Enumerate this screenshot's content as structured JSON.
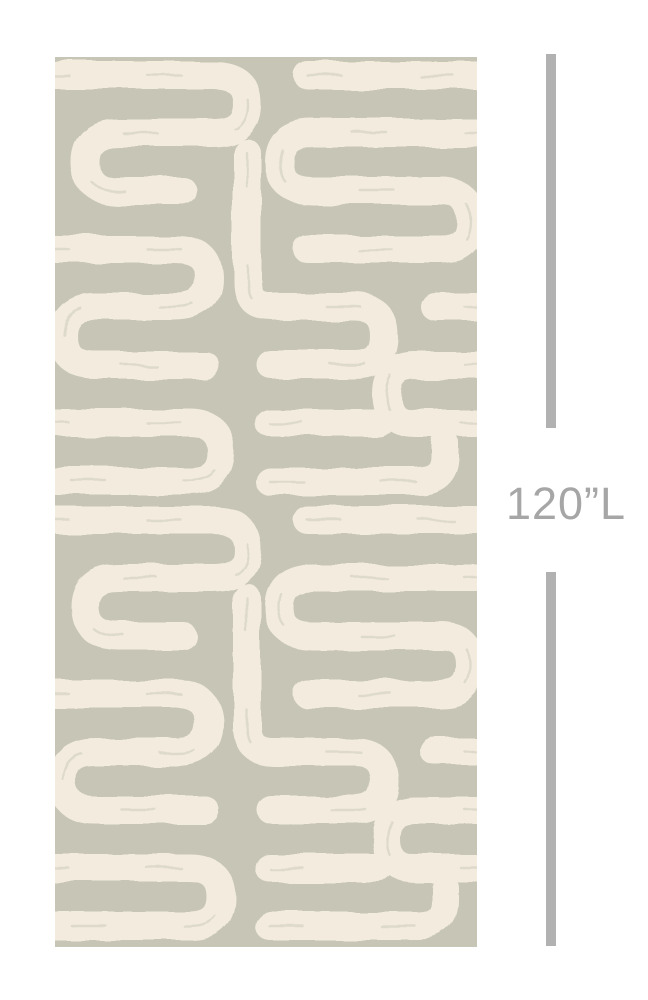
{
  "figure": {
    "type": "product-dimension-image",
    "swatch": {
      "description": "Wallpaper swatch with abstract hand-painted maze pattern of thick cream brushstroke lines with rounded ends on a sage gray-green background"
    },
    "dimension": {
      "label": "120”L"
    }
  },
  "colors": {
    "page": "#ffffff",
    "sage": "#c7c6b6",
    "cream": "#f2ebde",
    "dimension_gray": "#b1b1b1",
    "label_gray": "#a6a6a6"
  }
}
